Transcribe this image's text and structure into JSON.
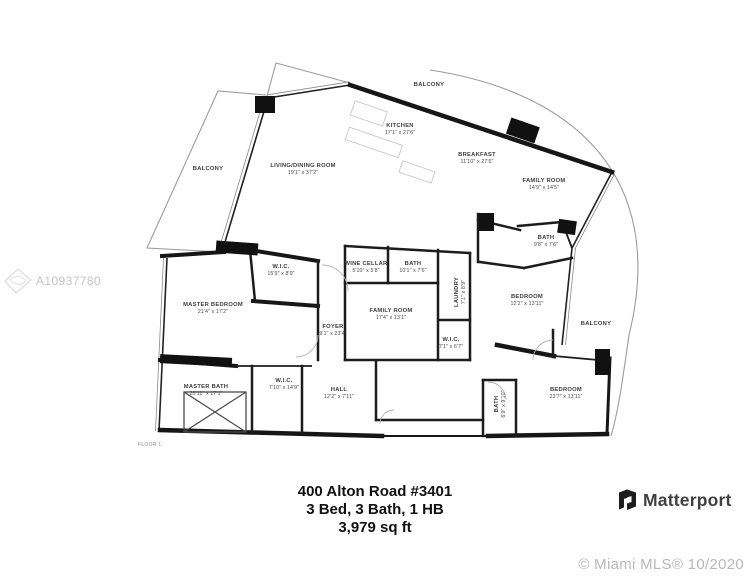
{
  "colors": {
    "wall": "#1a1a1a",
    "label": "#3d3d3d",
    "watermark": "#c2c2c2"
  },
  "watermarks": {
    "mls_id": "A10937780",
    "copyright": "© Miami MLS® 10/2020"
  },
  "footer": {
    "address": "400 Alton Road #3401",
    "specs": "3 Bed, 3 Bath, 1 HB",
    "area": "3,979 sq ft"
  },
  "branding": {
    "logo_text": "Matterport"
  },
  "floor_plan": {
    "floor_label": "FLOOR 1",
    "rooms": [
      {
        "name": "BALCONY",
        "dims": "",
        "x": 429,
        "y": 86,
        "rot": 0
      },
      {
        "name": "BALCONY",
        "dims": "",
        "x": 208,
        "y": 170,
        "rot": 0
      },
      {
        "name": "BALCONY",
        "dims": "",
        "x": 596,
        "y": 325,
        "rot": 0
      },
      {
        "name": "KITCHEN",
        "dims": "17'1\" x 27'6\"",
        "x": 400,
        "y": 127,
        "rot": 0
      },
      {
        "name": "LIVING/DINING ROOM",
        "dims": "19'1\" x 37'2\"",
        "x": 303,
        "y": 167,
        "rot": 0
      },
      {
        "name": "BREAKFAST",
        "dims": "11'10\" x 27'6\"",
        "x": 477,
        "y": 156,
        "rot": 0
      },
      {
        "name": "FAMILY ROOM",
        "dims": "14'9\" x 14'5\"",
        "x": 544,
        "y": 182,
        "rot": 0
      },
      {
        "name": "BATH",
        "dims": "9'8\" x 7'6\"",
        "x": 546,
        "y": 239,
        "rot": 0
      },
      {
        "name": "BEDROOM",
        "dims": "12'2\" x 13'11\"",
        "x": 527,
        "y": 298,
        "rot": 0
      },
      {
        "name": "W.I.C.",
        "dims": "15'9\" x 8'9\"",
        "x": 281,
        "y": 268,
        "rot": 0
      },
      {
        "name": "WINE CELLAR",
        "dims": "5'10\" x 5'8\"",
        "x": 366,
        "y": 265,
        "rot": 0
      },
      {
        "name": "BATH",
        "dims": "10'1\" x 7'6\"",
        "x": 413,
        "y": 265,
        "rot": 0
      },
      {
        "name": "LAUNDRY",
        "dims": "7'1\" x 8'9\"",
        "x": 458,
        "y": 292,
        "rot": -90
      },
      {
        "name": "MASTER BEDROOM",
        "dims": "21'4\" x 17'2\"",
        "x": 213,
        "y": 306,
        "rot": 0
      },
      {
        "name": "FAMILY ROOM",
        "dims": "17'4\" x 13'1\"",
        "x": 391,
        "y": 312,
        "rot": 0
      },
      {
        "name": "FOYER",
        "dims": "9'1\" x 23'4\"",
        "x": 333,
        "y": 328,
        "rot": 0
      },
      {
        "name": "W.I.C.",
        "dims": "7'1\" x 6'7\"",
        "x": 451,
        "y": 341,
        "rot": 0
      },
      {
        "name": "W.I.C.",
        "dims": "7'10\" x 14'9\"",
        "x": 284,
        "y": 382,
        "rot": 0
      },
      {
        "name": "MASTER BATH",
        "dims": "20'11\" x 17'1\"",
        "x": 206,
        "y": 388,
        "rot": 0
      },
      {
        "name": "HALL",
        "dims": "12'2\" x 7'11\"",
        "x": 339,
        "y": 391,
        "rot": 0
      },
      {
        "name": "BATH",
        "dims": "6'9\" x 9'10\"",
        "x": 498,
        "y": 404,
        "rot": -90
      },
      {
        "name": "BEDROOM",
        "dims": "23'7\" x 13'11\"",
        "x": 566,
        "y": 391,
        "rot": 0
      }
    ]
  }
}
